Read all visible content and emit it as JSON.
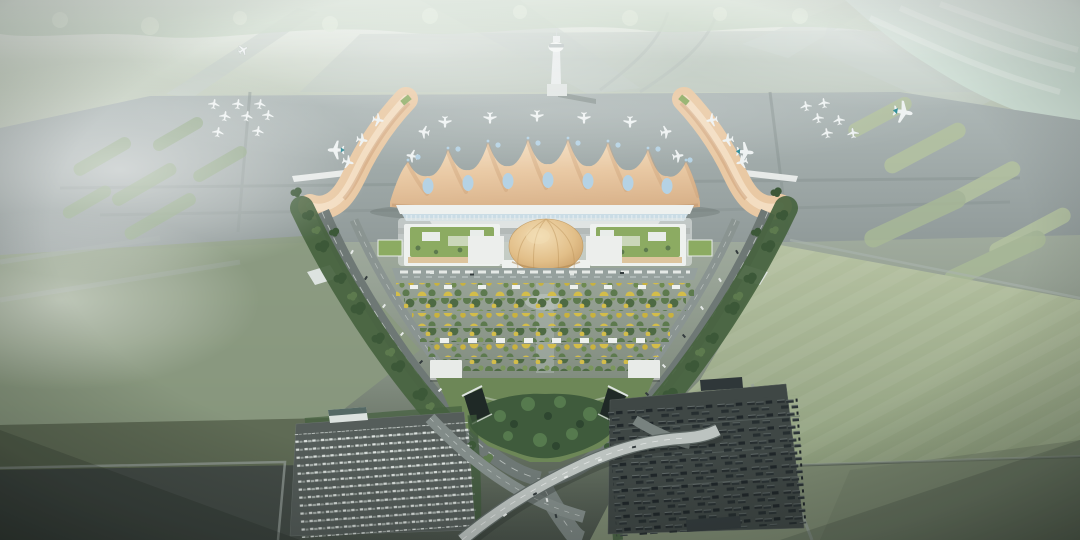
{
  "image": {
    "kind": "architectural-aerial-rendering",
    "description": "Bird's-eye architectural rendering of a new airport: a tan wave-roofed terminal with blue teardrop skylights and two curved piers, a golden-dome landside hall flanked by green-roof buildings, axial flowering gardens inside a teardrop loop road with highway ramps and twin tunnel portals, a car park and a bus park, aprons with parked white aircraft, taxiways with grass islands, a control tower, and hazy tree lines under morning mist.",
    "visible_text": []
  },
  "objects": [
    "misty-treeline",
    "runways-and-taxiways",
    "control-tower",
    "remote-aircraft-stands",
    "terminal-apron",
    "wave-roof-terminal",
    "west-pier",
    "east-pier",
    "golden-dome-hall",
    "green-roof-buildings",
    "axial-gardens",
    "loop-roads",
    "highway-ramps",
    "tunnel-portals",
    "car-park",
    "bus-park",
    "grass-airfield"
  ],
  "palette": {
    "haze_top": "#e8eee8",
    "apron_gray": "#a5afae",
    "taxiway_gray": "#8b9694",
    "runway_light": "#c6cfca",
    "roof_tan": "#e9c9a4",
    "roof_shade": "#c79a70",
    "roof_light": "#f6e3cb",
    "skylight_blue": "#b5d2e4",
    "glass_blue": "#cadce5",
    "white_structure": "#eef1ef",
    "dome_gold": "#ddb87e",
    "green_roof": "#8cab62",
    "tree_dark": "#3c5838",
    "tree_mid": "#5d7a4e",
    "tree_pale": "#c6d4c4",
    "garden_yellow": "#d3bd4a",
    "park_green": "#6d8757",
    "road_gray": "#6e7875",
    "ramp_light": "#bcc3c0",
    "lane_white": "#e8ecea",
    "parking_gray": "#555d5a",
    "bus_lot_dark": "#3f4745",
    "vehicle_dark": "#262d2f",
    "car_white": "#e3e8e5",
    "plane_white": "#eef2f2",
    "tail_teal": "#2e8b96",
    "tower_white": "#e8ecec",
    "grass_field": "#a4b490",
    "grass_dark": "#5f6b55",
    "asphalt_dark": "#454d48",
    "mist": "#ffffff"
  }
}
